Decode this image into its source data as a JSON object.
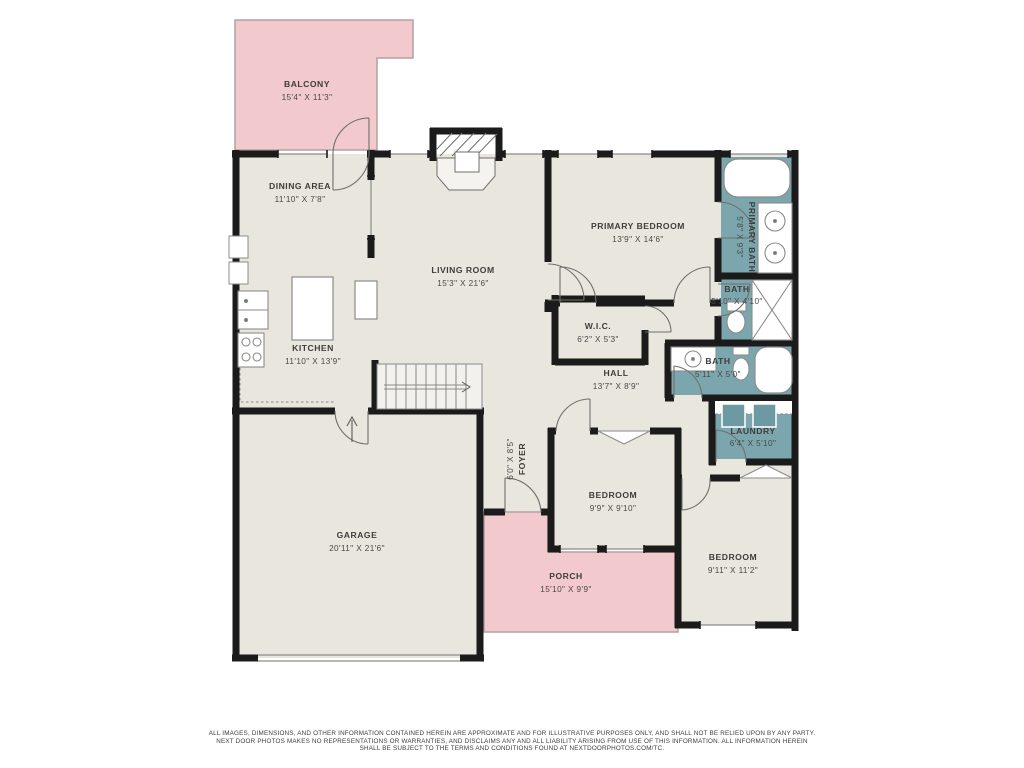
{
  "plan_title": "Residential floor plan",
  "colors": {
    "walls": "#1b1b1b",
    "interior": "#e9e6de",
    "outdoor": "#f2c9cc",
    "wet_rooms": "#7ca6ae",
    "appliance": "#6d99a3",
    "background": "#ffffff"
  },
  "rooms": [
    {
      "id": "balcony",
      "name": "BALCONY",
      "dims": "15'4\" X 11'3\""
    },
    {
      "id": "dining-area",
      "name": "DINING AREA",
      "dims": "11'10\" X 7'8\""
    },
    {
      "id": "living-room",
      "name": "LIVING ROOM",
      "dims": "15'3\" X 21'6\""
    },
    {
      "id": "primary-bedroom",
      "name": "PRIMARY BEDROOM",
      "dims": "13'9\" X 14'6\""
    },
    {
      "id": "primary-bath",
      "name": "PRIMARY BATH",
      "dims": "5'8\" X 9'3\""
    },
    {
      "id": "bath-upper",
      "name": "BATH",
      "dims": "5'10\" X 4'10\""
    },
    {
      "id": "wic",
      "name": "W.I.C.",
      "dims": "6'2\" X 5'3\""
    },
    {
      "id": "hall",
      "name": "HALL",
      "dims": "13'7\" X 8'9\""
    },
    {
      "id": "bath-lower",
      "name": "BATH",
      "dims": "5'11\" X 5'0\""
    },
    {
      "id": "laundry",
      "name": "LAUNDRY",
      "dims": "6'4\" X 5'10\""
    },
    {
      "id": "kitchen",
      "name": "KITCHEN",
      "dims": "11'10\" X 13'9\""
    },
    {
      "id": "foyer",
      "name": "FOYER",
      "dims": "6'0\" X 8'5\""
    },
    {
      "id": "bedroom-center",
      "name": "BEDROOM",
      "dims": "9'9\" X 9'10\""
    },
    {
      "id": "bedroom-right",
      "name": "BEDROOM",
      "dims": "9'11\" X 11'2\""
    },
    {
      "id": "garage",
      "name": "GARAGE",
      "dims": "20'11\" X 21'6\""
    },
    {
      "id": "porch",
      "name": "PORCH",
      "dims": "15'10\" X 9'9\""
    }
  ],
  "disclaimer": {
    "line1": "ALL IMAGES, DIMENSIONS, AND OTHER INFORMATION CONTAINED HEREIN ARE APPROXIMATE AND FOR ILLUSTRATIVE PURPOSES ONLY, AND SHALL NOT BE RELIED UPON BY ANY PARTY.",
    "line2": "NEXT DOOR PHOTOS MAKES NO REPRESENTATIONS OR WARRANTIES, AND DISCLAIMS ANY AND ALL LIABILITY ARISING FROM USE OF THIS INFORMATION. ALL INFORMATION HEREIN",
    "line3": "SHALL BE SUBJECT TO THE TERMS AND CONDITIONS FOUND AT NEXTDOORPHOTOS.COM/TC."
  }
}
